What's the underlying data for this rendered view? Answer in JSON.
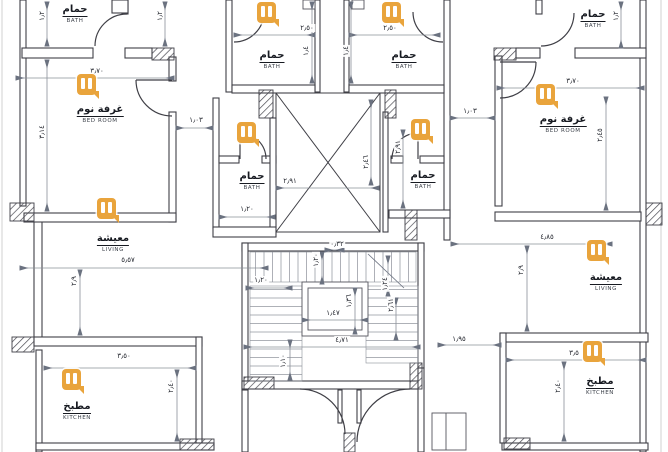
{
  "colors": {
    "marker_orange": "#E9A43C",
    "wall": "#3F3F46",
    "dim_line": "#8A9099",
    "text": "#171A21",
    "background": "#FFFFFF"
  },
  "marker_icon": "pause-bubble-watermark",
  "rooms": [
    {
      "ar": "حمام",
      "en": "BATH"
    },
    {
      "ar": "حمام",
      "en": "BATH"
    },
    {
      "ar": "حمام",
      "en": "BATH"
    },
    {
      "ar": "حمام",
      "en": "BATH"
    },
    {
      "ar": "غرفة نوم",
      "en": "BED ROOM"
    },
    {
      "ar": "غرفة نوم",
      "en": "BED ROOM"
    },
    {
      "ar": "حمام",
      "en": "BATH"
    },
    {
      "ar": "حمام",
      "en": "BATH"
    },
    {
      "ar": "معيشة",
      "en": "LIVING"
    },
    {
      "ar": "معيشة",
      "en": "LIVING"
    },
    {
      "ar": "مطبخ",
      "en": "KITCHEN"
    },
    {
      "ar": "مطبخ",
      "en": "KITCHEN"
    }
  ],
  "dimensions": [
    {
      "v": "٣٫٧٠"
    },
    {
      "v": "٣٫٧٠"
    },
    {
      "v": "٢٫٥٠"
    },
    {
      "v": "٢٫٥٠"
    },
    {
      "v": "١٫٠٣"
    },
    {
      "v": "١٫٠٣"
    },
    {
      "v": "٢٫٩١"
    },
    {
      "v": "١٫٢٠"
    },
    {
      "v": "٤٫٨٥"
    },
    {
      "v": "٥٫٥٧"
    },
    {
      "v": "١٫٢٠"
    },
    {
      "v": "٠٫٣٢"
    },
    {
      "v": "١٫٤٧"
    },
    {
      "v": "٤٫٧١"
    },
    {
      "v": "٣٫٥٠"
    },
    {
      "v": "١٫٩٥"
    },
    {
      "v": "٣٫٥"
    },
    {
      "v": "١٫٢"
    },
    {
      "v": "١٫٢"
    },
    {
      "v": "١٫٢"
    },
    {
      "v": "٣٫١٤"
    },
    {
      "v": "٢٫٤٥"
    },
    {
      "v": "١٫٤"
    },
    {
      "v": "١٫٤"
    },
    {
      "v": "٢٫٤٦"
    },
    {
      "v": "٢٫٩١"
    },
    {
      "v": "٢٫٩"
    },
    {
      "v": "٢٫٩"
    },
    {
      "v": "٢٫٤٠"
    },
    {
      "v": "٢٫٤٠"
    },
    {
      "v": "١٫٢٠"
    },
    {
      "v": "١٫٣٦"
    },
    {
      "v": "١٫١٠"
    },
    {
      "v": "١٫٢٤"
    },
    {
      "v": "٢٫٦١"
    }
  ]
}
